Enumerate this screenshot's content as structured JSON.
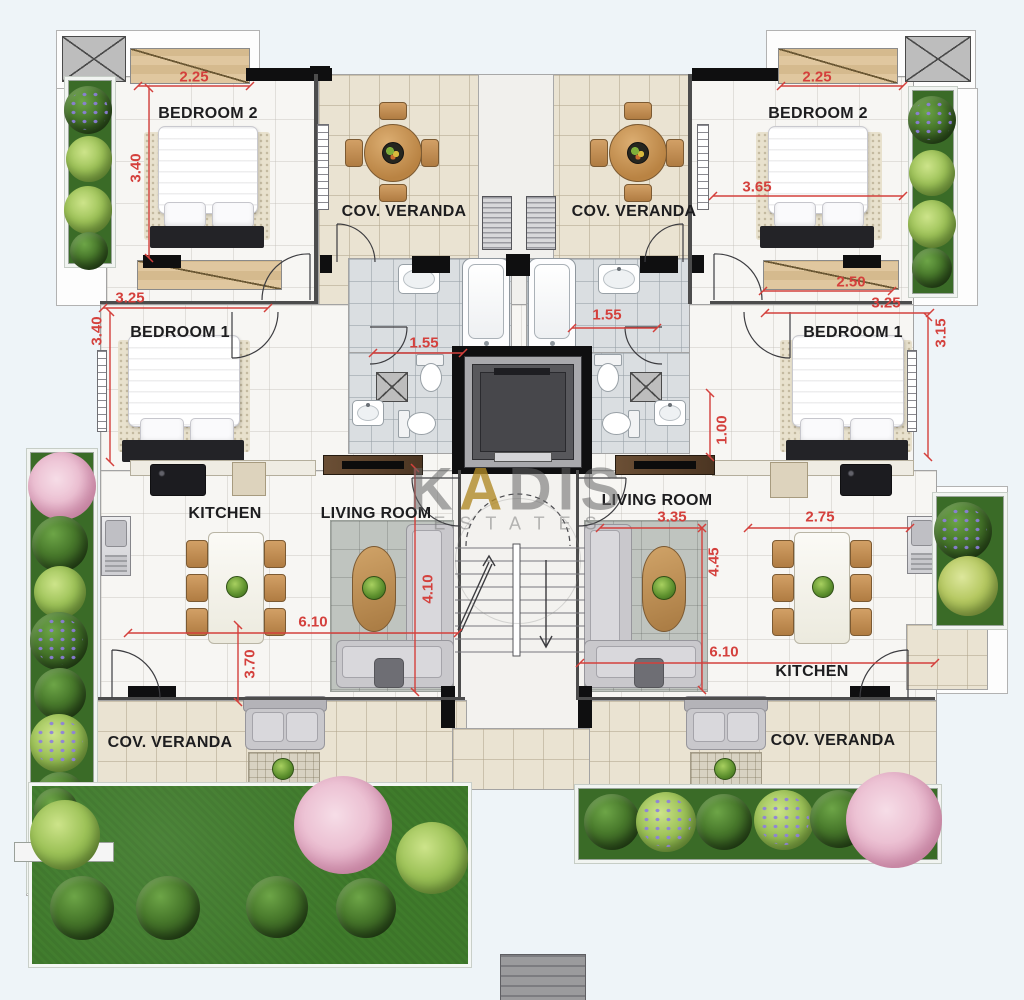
{
  "brand": {
    "k": "K",
    "a": "A",
    "dis": "DIS",
    "sub": "ESTATES"
  },
  "rooms": {
    "bedroom2_left": "BEDROOM 2",
    "bedroom2_right": "BEDROOM 2",
    "bedroom1_left": "BEDROOM 1",
    "bedroom1_right": "BEDROOM 1",
    "veranda_top_left": "COV. VERANDA",
    "veranda_top_right": "COV. VERANDA",
    "veranda_bottom_left": "COV. VERANDA",
    "veranda_bottom_right": "COV. VERANDA",
    "kitchen_left": "KITCHEN",
    "kitchen_right": "KITCHEN",
    "living_left": "LIVING ROOM",
    "living_right": "LIVING ROOM"
  },
  "dims": {
    "tl_w": "2.25",
    "tl_h": "3.40",
    "bl1_w": "3.25",
    "bl1_h": "3.40",
    "bath_l": "1.55",
    "bath_r": "1.55",
    "tr_w": "2.25",
    "tr_mid": "3.65",
    "tr_low": "2.50",
    "br1_w": "3.25",
    "br1_h": "3.15",
    "hall_r": "1.00",
    "liv_l_h": "4.10",
    "unit_l_w": "6.10",
    "unit_l_low": "3.70",
    "liv_r_w": "3.35",
    "kit_r_w": "2.75",
    "liv_r_h": "4.45",
    "unit_r_w": "6.10"
  },
  "colors": {
    "dimension": "#d4403c",
    "label": "#1d1d1f",
    "lawn": "#3f7b2b",
    "gold": "#b08a28"
  }
}
